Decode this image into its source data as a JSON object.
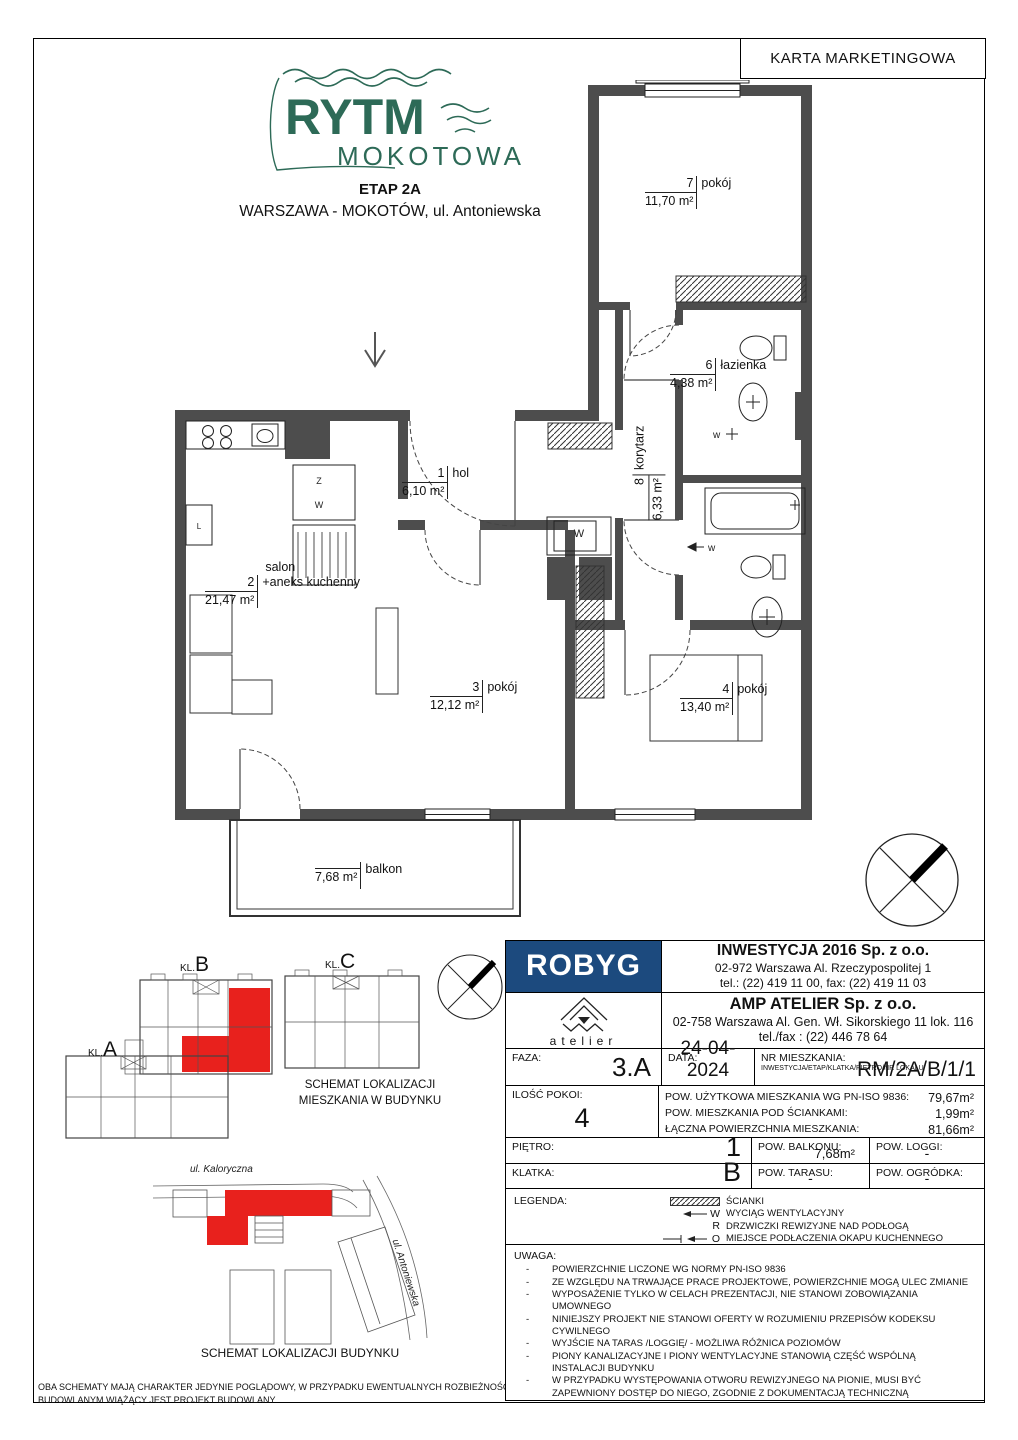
{
  "page": {
    "karta_title": "KARTA MARKETINGOWA"
  },
  "header": {
    "logo_line1": "RYTM",
    "logo_line2": "MOKOTOWA",
    "etap": "ETAP 2A",
    "address": "WARSZAWA - MOKOTÓW, ul. Antoniewska",
    "brand_green": "#2d6a57"
  },
  "colors": {
    "wall_gray": "#4d4d4d",
    "highlight_red": "#e8211d",
    "robyg_blue": "#1c4a7e"
  },
  "floorplan": {
    "rooms": [
      {
        "no": "1",
        "name": "hol",
        "area": "6,10 m²"
      },
      {
        "no": "2",
        "prefix": "salon",
        "name": "+aneks kuchenny",
        "area": "21,47 m²"
      },
      {
        "no": "3",
        "name": "pokój",
        "area": "12,12 m²"
      },
      {
        "no": "4",
        "name": "pokój",
        "area": "13,40 m²"
      },
      {
        "no": "5",
        "name": "łazienka",
        "area": "4,17 m²"
      },
      {
        "no": "6",
        "name": "łazienka",
        "area": "4,38 m²"
      },
      {
        "no": "7",
        "name": "pokój",
        "area": "11,70 m²"
      },
      {
        "no": "8",
        "name": "korytarz",
        "area": "6,33 m²"
      }
    ],
    "balkon": {
      "name": "balkon",
      "area": "7,68 m²"
    },
    "fixtures": {
      "washer": "W",
      "kitchen_z": "Z",
      "kitchen_w": "W",
      "vent": "w",
      "l_box": "L"
    }
  },
  "developer": {
    "logo": "ROBYG",
    "name": "INWESTYCJA 2016 Sp. z o.o.",
    "address": "02-972 Warszawa Al. Rzeczypospolitej 1",
    "phone": "tel.: (22) 419 11 00, fax: (22) 419 11 03"
  },
  "architect": {
    "logo_word": "atelier",
    "name": "AMP ATELIER Sp. z o.o.",
    "address": "02-758 Warszawa Al. Gen. Wł. Sikorskiego 11 lok. 116",
    "phone": "tel./fax : (22) 446 78 64"
  },
  "details": {
    "faza_label": "FAZA:",
    "faza": "3.A",
    "data_label": "DATA:",
    "data": "24-04-2024",
    "nr_label": "NR MIESZKANIA:",
    "nr_sub": "INWESTYCJA/ETAP/KLATKA/PIĘTRO/NR LOKALU",
    "nr": "RM/2A/B/1/1",
    "ilosc_label": "ILOŚĆ POKOI:",
    "ilosc": "4",
    "pow1_label": "POW. UŻYTKOWA MIESZKANIA WG PN-ISO 9836:",
    "pow1": "79,67m²",
    "pow2_label": "POW. MIESZKANIA POD ŚCIANKAMI:",
    "pow2": "1,99m²",
    "pow3_label": "ŁĄCZNA POWIERZCHNIA MIESZKANIA:",
    "pow3": "81,66m²",
    "pietro_label": "PIĘTRO:",
    "pietro": "1",
    "balkon_label": "POW. BALKONU:",
    "balkon": "7,68m²",
    "loggi_label": "POW. LOGGI:",
    "loggi": "-",
    "klatka_label": "KLATKA:",
    "klatka": "B",
    "taras_label": "POW. TARASU:",
    "taras": "-",
    "ogrodek_label": "POW. OGRÓDKA:",
    "ogrodek": "-"
  },
  "legend": {
    "label": "LEGENDA:",
    "items": [
      {
        "letter": "",
        "text": "ŚCIANKI"
      },
      {
        "letter": "W",
        "text": "WYCIĄG WENTYLACYJNY"
      },
      {
        "letter": "R",
        "text": "DRZWICZKI REWIZYJNE NAD PODŁOGĄ"
      },
      {
        "letter": "O",
        "text": "MIEJSCE PODŁACZENIA OKAPU KUCHENNEGO"
      }
    ]
  },
  "uwaga": {
    "label": "UWAGA:",
    "items": [
      "POWIERZCHNIE LICZONE WG NORMY PN-ISO 9836",
      "ZE WZGLĘDU NA TRWAJĄCE PRACE PROJEKTOWE, POWIERZCHNIE MOGĄ ULEC ZMIANIE",
      "WYPOSAŻENIE TYLKO W CELACH PREZENTACJI, NIE STANOWI ZOBOWIĄZANIA UMOWNEGO",
      "NINIEJSZY PROJEKT NIE STANOWI OFERTY W ROZUMIENIU PRZEPISÓW KODEKSU CYWILNEGO",
      "WYJŚCIE NA TARAS /LOGGIĘ/ - MOŻLIWA RÓŻNICA POZIOMÓW",
      "PIONY KANALIZACYJNE I PIONY WENTYLACYJNE STANOWIĄ CZĘŚĆ WSPÓLNĄ INSTALACJI BUDYNKU",
      "W PRZYPADKU WYSTĘPOWANIA OTWORU REWIZYJNEGO NA PIONIE, MUSI BYĆ ZAPEWNIONY DOSTĘP DO NIEGO, ZGODNIE Z DOKUMENTACJĄ TECHNICZNĄ"
    ]
  },
  "schematics": {
    "kl_a_prefix": "KL.",
    "kl_a": "A",
    "kl_b_prefix": "KL.",
    "kl_b": "B",
    "kl_c_prefix": "KL.",
    "kl_c": "C",
    "caption1_line1": "SCHEMAT LOKALIZACJI",
    "caption1_line2": "MIESZKANIA W BUDYNKU",
    "caption2": "SCHEMAT LOKALIZACJI BUDYNKU",
    "street1": "ul. Kaloryczna",
    "street2": "ul. Antoniewska",
    "disclaimer": "OBA SCHEMATY MAJĄ CHARAKTER JEDYNIE POGLĄDOWY, W PRZYPADKU EWENTUALNYCH ROZBIEŻNOŚCI POMIĘDZY SCHEMATAMI A PROJEKTEM BUDOWLANYM WIĄŻĄCY JEST PROJEKT BUDOWLANY"
  }
}
